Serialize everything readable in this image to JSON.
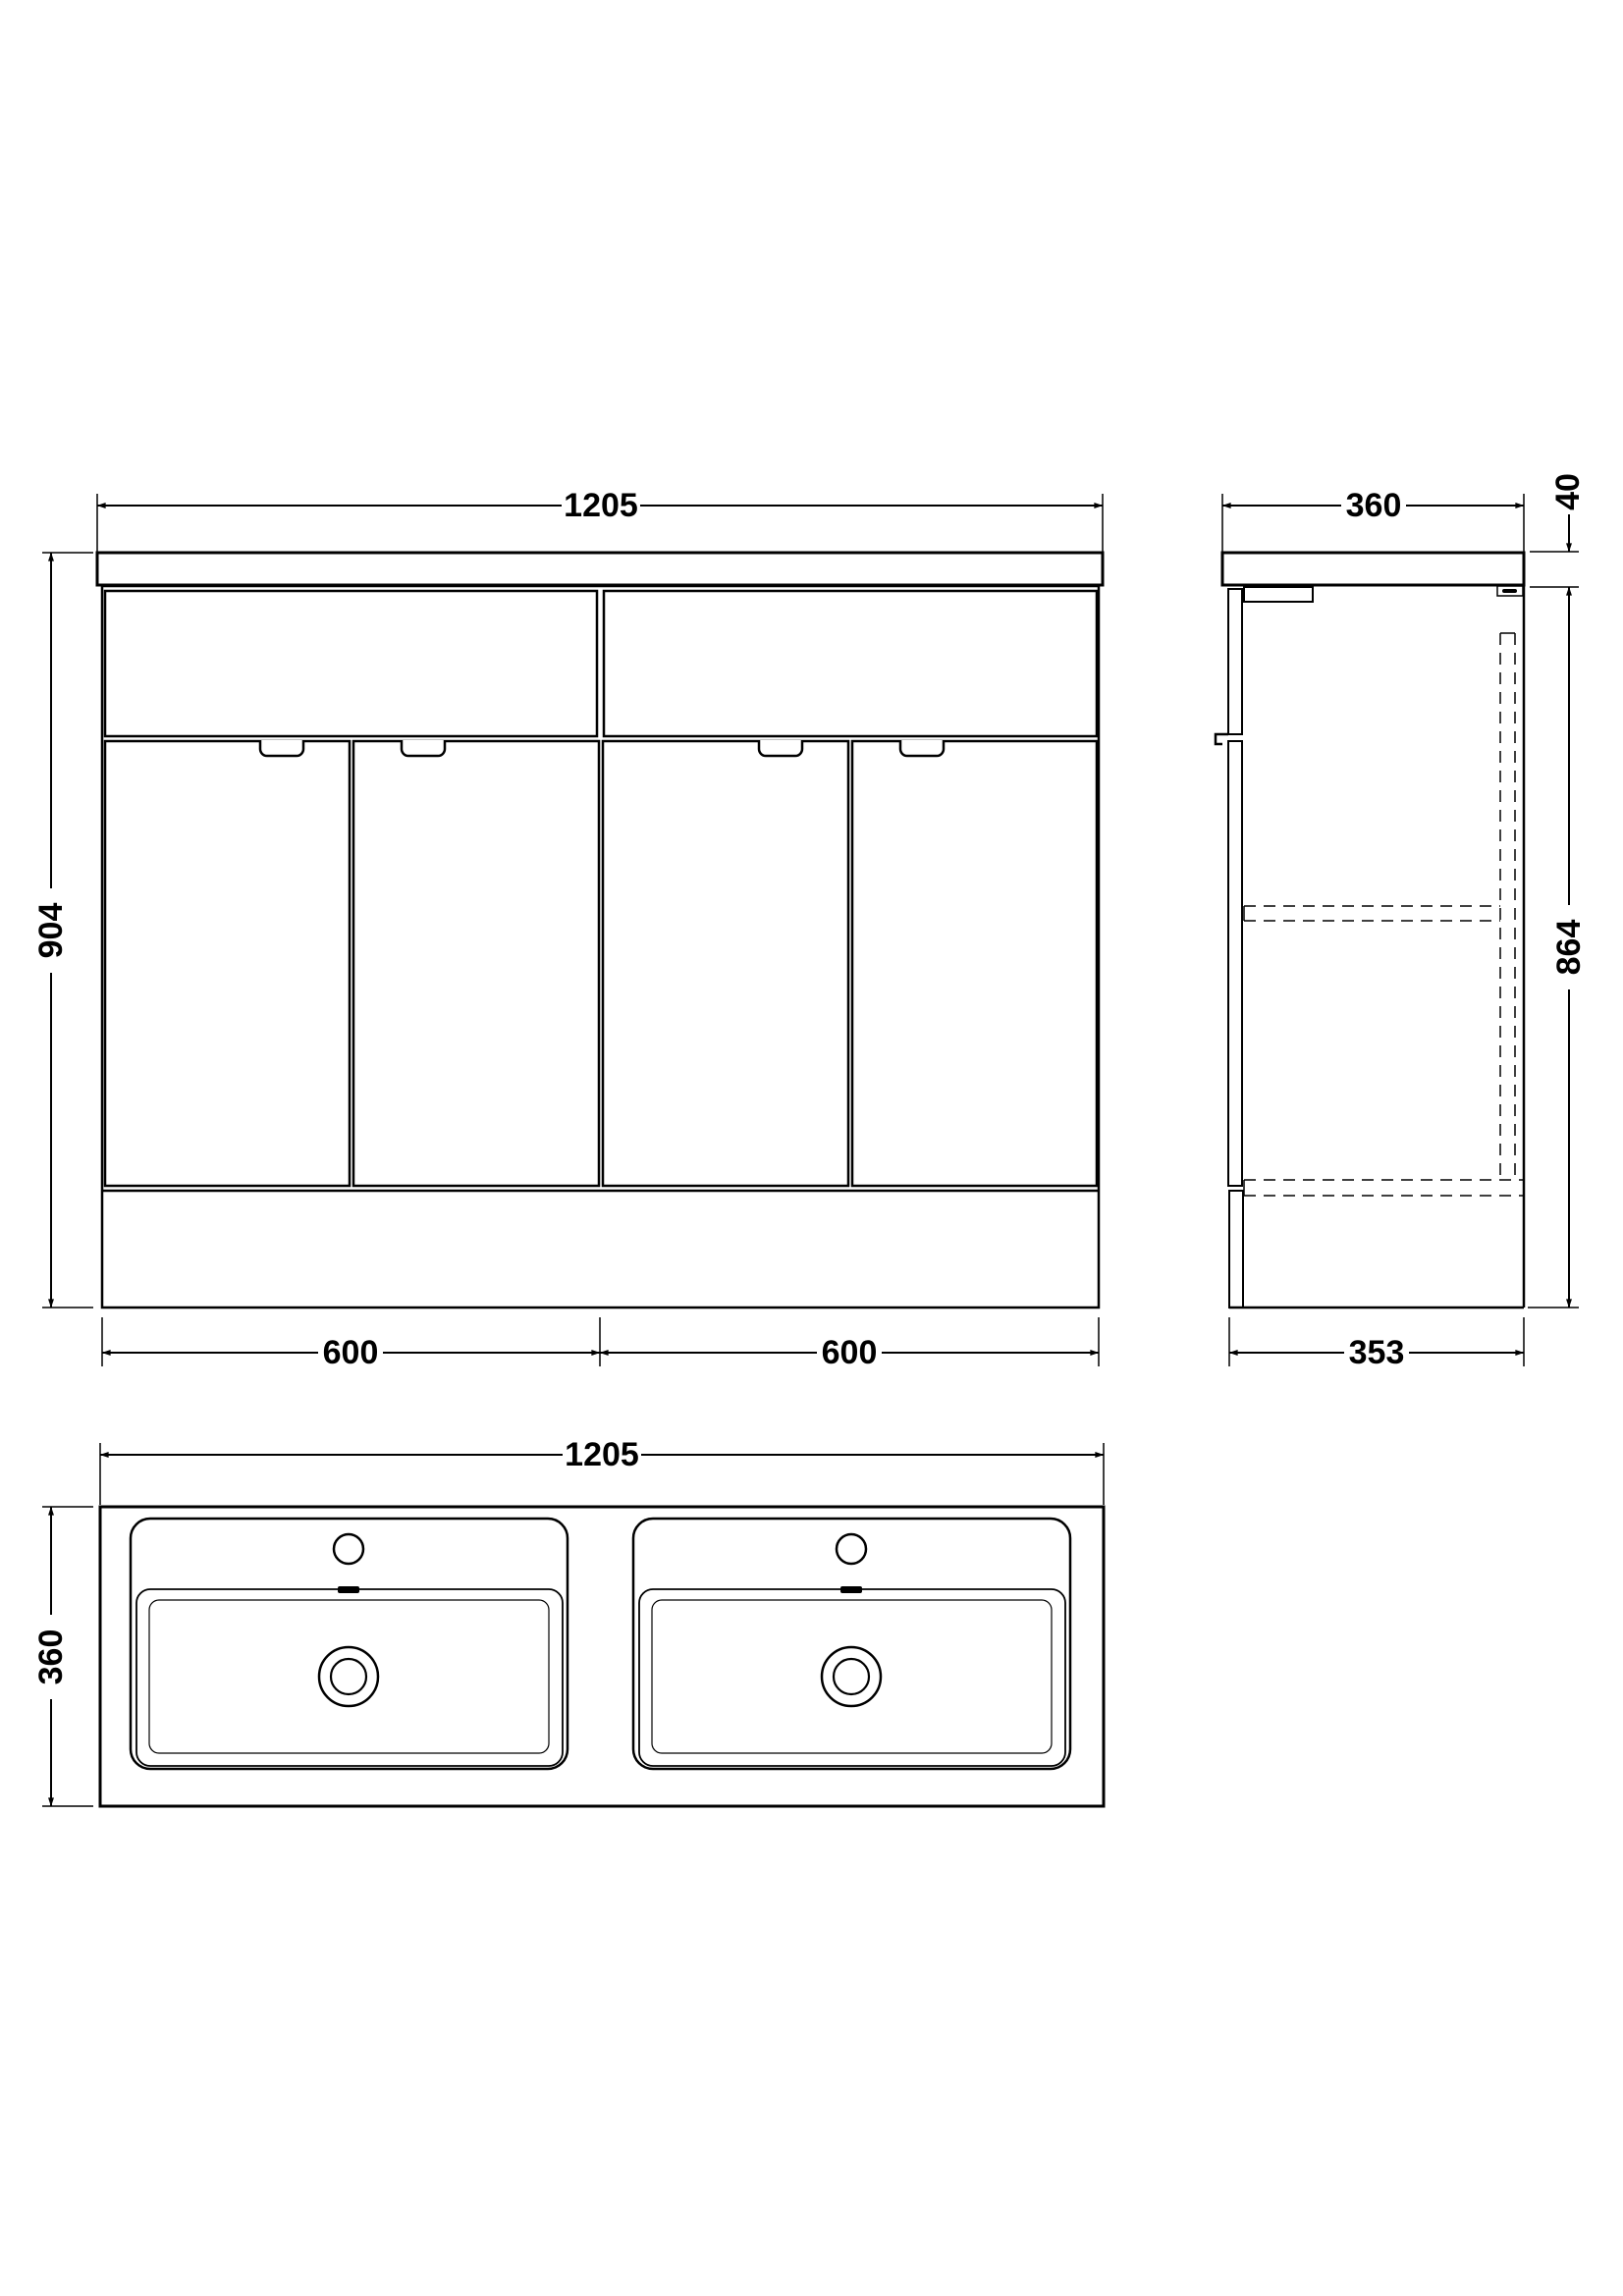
{
  "drawing": {
    "kind": "vanity-unit-technical-drawing",
    "views": [
      "front-elevation",
      "side-section",
      "plan-basin"
    ],
    "units": "mm"
  },
  "colors": {
    "line": "#000000",
    "background": "#ffffff"
  },
  "dimensions": {
    "front_width": "1205",
    "front_height": "904",
    "front_module_left": "600",
    "front_module_right": "600",
    "side_depth": "360",
    "counter_thickness": "40",
    "cabinet_height": "864",
    "cabinet_depth": "353",
    "plan_width": "1205",
    "plan_depth": "360"
  }
}
